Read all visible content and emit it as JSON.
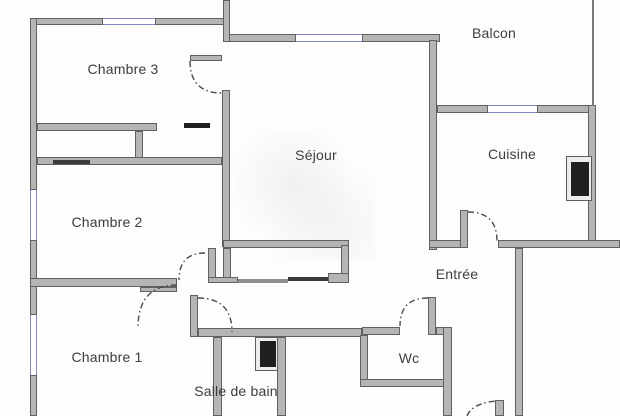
{
  "floorplan": {
    "title": "Apartment floor plan",
    "rooms": [
      {
        "id": "chambre3",
        "label": "Chambre 3"
      },
      {
        "id": "balcon",
        "label": "Balcon"
      },
      {
        "id": "sejour",
        "label": "Séjour"
      },
      {
        "id": "cuisine",
        "label": "Cuisine"
      },
      {
        "id": "chambre2",
        "label": "Chambre 2"
      },
      {
        "id": "entree",
        "label": "Entrée"
      },
      {
        "id": "chambre1",
        "label": "Chambre 1"
      },
      {
        "id": "wc",
        "label": "Wc"
      },
      {
        "id": "salle_de_bain",
        "label": "Salle de bain"
      }
    ],
    "colors": {
      "wall_fill": "#b5b5b5",
      "wall_edge": "#616161",
      "window_blue": "#8089c6",
      "door_black": "#1f1f1f",
      "label_text": "#3d3d3d",
      "background": "#fdfdfc"
    }
  }
}
